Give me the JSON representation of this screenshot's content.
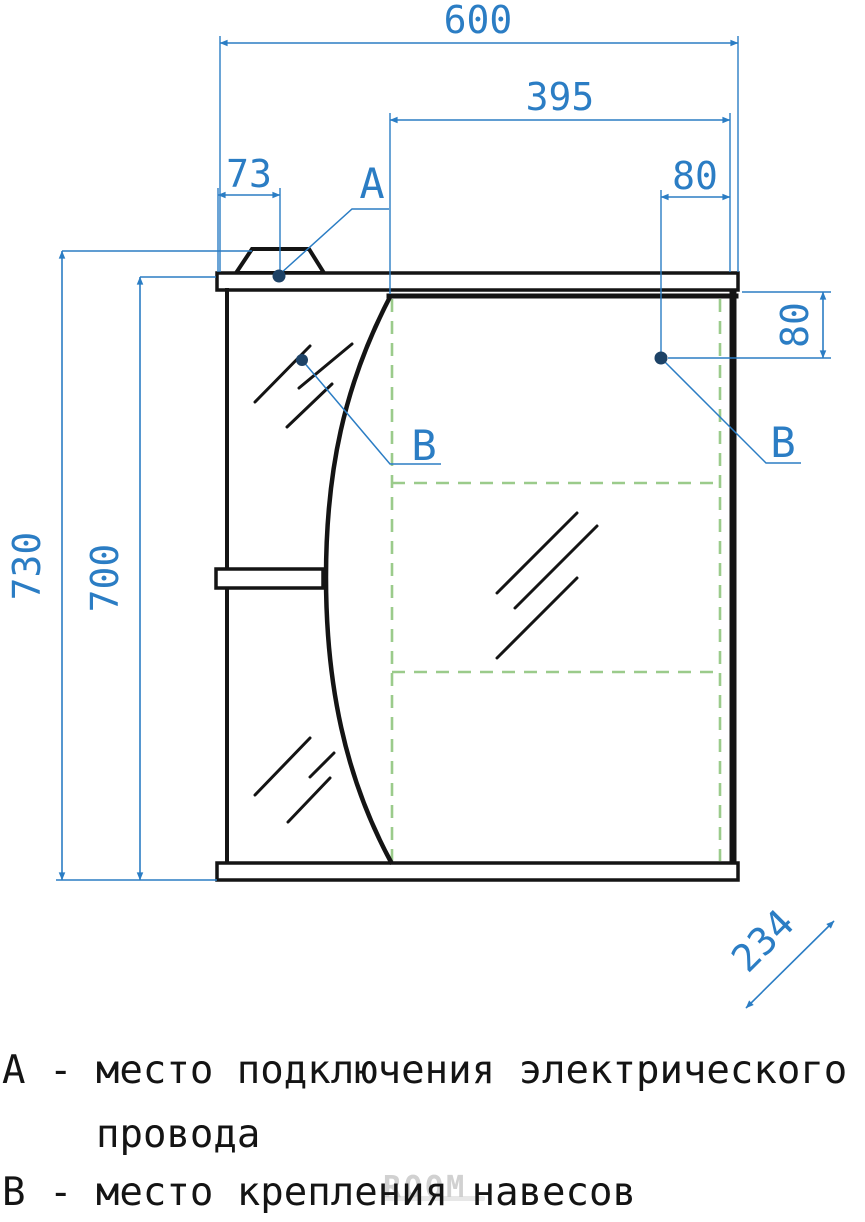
{
  "drawing": {
    "dimensions": {
      "total_width_mm": "600",
      "door_width_mm": "395",
      "lamp_offset_mm": "73",
      "hinge_offset_top_mm": "80",
      "hinge_offset_side_mm": "80",
      "total_height_mm": "730",
      "body_height_mm": "700",
      "depth_mm": "234"
    },
    "point_labels": {
      "a": "А",
      "b_left": "В",
      "b_right": "В"
    }
  },
  "legend": {
    "line1": "А - место подключения электрического",
    "line2": "провода",
    "line3": "В - место крепления навесов"
  },
  "watermark": {
    "text": "ROOM"
  },
  "colors": {
    "dimension_blue": "#2b7dc4",
    "marker_dot": "#1d4266",
    "outline_black": "#141414",
    "dashed_green": "#9bcb8b",
    "watermark_gray": "#c9c9c9",
    "background": "#ffffff"
  }
}
